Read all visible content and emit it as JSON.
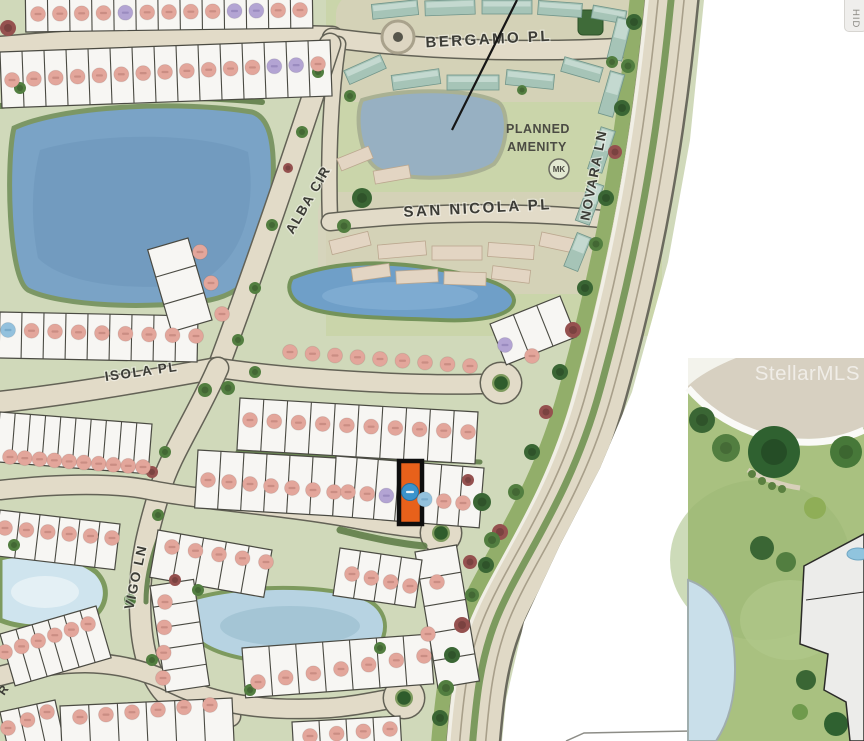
{
  "watermark": "StellarMLS",
  "hide_button": {
    "label": "HID"
  },
  "streets": {
    "bergamo": "BERGAMO PL",
    "san_nicola": "SAN NICOLA PL",
    "novara": "NOVARA LN",
    "alba": "ALBA CIR",
    "isola": "ISOLA PL",
    "vigo": "VIGO LN",
    "partial_r": "R"
  },
  "amenity": {
    "line1": "PLANNED",
    "line2": "AMENITY",
    "badge": "MK"
  },
  "colors": {
    "marker_pink": "#E3A69B",
    "marker_purple": "#B3A4D3",
    "marker_blue": "#93C1DD",
    "marker_pink_text": "#C2847B",
    "marker_purple_text": "#9183B8",
    "marker_blue_text": "#6FA3C4",
    "highlight_orange": "#E8611B",
    "highlight_outline": "#0E0E0E",
    "highlight_marker_blue": "#3B93CC",
    "lot_fill": "#F7F6F3",
    "lot_stroke": "#4A4A42",
    "road_tan": "#E2DBC8",
    "road_edge": "#636256",
    "base_green": "#D0D9BA",
    "water_dark": "#7AA3C6",
    "water_light": "#B7D3E2"
  },
  "highlighted_lot": {
    "x": 399,
    "y": 461,
    "w": 23,
    "h": 63,
    "marker_x": 410,
    "marker_y": 492
  },
  "map": {
    "lakes": [
      {
        "d": "M14,128 C60,106 180,100 252,112 C272,118 276,150 272,200 C268,252 258,290 210,300 C150,310 60,306 28,290 C8,278 6,160 14,128 Z",
        "f": "#7AA3C6",
        "s": "#7C9765",
        "sw": 5
      },
      {
        "d": "M40,150 C100,132 200,132 248,152 C256,200 248,258 198,283 C130,293 62,283 38,258 C30,218 32,180 40,150 Z",
        "f": "#6B95BA",
        "o": 0.55
      },
      {
        "d": "M362,100 C400,88 470,88 498,102 C510,110 508,148 494,164 C470,180 410,182 380,170 C360,162 354,116 362,100 Z",
        "f": "#97B0C2",
        "s": "#A9B193",
        "sw": 4
      },
      {
        "d": "M292,278 C330,262 380,260 430,268 C480,276 512,284 514,300 C514,314 488,322 440,320 C392,318 330,318 304,306 C290,300 286,288 292,278 Z",
        "f": "#6F9FC8",
        "s": "#74935A",
        "sw": 4
      },
      {
        "e": [
          400,
          296,
          78,
          14
        ],
        "f": "#8AB4D8",
        "o": 0.55
      },
      {
        "d": "M196,598 C240,586 310,584 356,596 C382,602 390,622 382,640 C370,660 320,668 268,662 C228,658 200,648 192,632 C186,618 188,606 196,598 Z",
        "f": "#B7D3E2",
        "s": "#7D9A5E",
        "sw": 4
      },
      {
        "e": [
          290,
          626,
          70,
          20
        ],
        "f": "#98BCCD",
        "o": 0.6
      },
      {
        "d": "M0,558 C36,550 76,556 96,572 C110,586 108,606 92,618 C68,630 24,630 0,620 Z",
        "f": "#CFE4EE",
        "s": "#7D9A5E",
        "sw": 5
      },
      {
        "e": [
          45,
          592,
          34,
          16
        ],
        "f": "#E8F2F6",
        "o": 0.8
      }
    ],
    "roads": [
      {
        "d": "M0,48 C110,38 220,34 332,38",
        "w": 22
      },
      {
        "d": "M332,38 C420,50 540,54 648,46",
        "w": 18
      },
      {
        "d": "M338,44 C330,100 328,160 330,222",
        "w": 14
      },
      {
        "d": "M330,222 C420,212 520,210 612,220",
        "w": 16
      },
      {
        "d": "M330,44 C302,130 262,250 218,368",
        "w": 20
      },
      {
        "d": "M0,402 C80,393 150,380 218,368",
        "w": 20
      },
      {
        "d": "M218,368 C300,380 420,386 482,384",
        "w": 18,
        "b": [
          501,
          383,
          20
        ]
      },
      {
        "d": "M218,368 C195,420 170,455 160,490 C148,530 140,560 140,600 C140,645 148,672 162,690 C175,706 198,714 230,716",
        "w": 20
      },
      {
        "d": "M0,490 C55,484 110,482 150,490 C200,500 280,505 352,518 C385,524 405,527 420,528",
        "w": 18,
        "b": [
          441,
          533,
          20
        ]
      },
      {
        "d": "M0,676 C70,657 122,658 176,685 C214,703 260,712 330,708 C355,706 372,702 384,700",
        "w": 18,
        "b": [
          404,
          698,
          20
        ]
      }
    ],
    "novara_layers": [
      {
        "d": "M672,-10 C658,140 636,260 600,390 C570,500 520,560 496,620 C480,660 476,700 472,750",
        "w": 57,
        "c": "#6B6A5E"
      },
      {
        "d": "M672,-10 C658,140 636,260 600,390 C570,500 520,560 496,620 C480,660 476,700 472,750",
        "w": 52,
        "c": "#E0D9C6"
      },
      {
        "d": "M659,-10 C645,140 623,260 587,390 C557,500 507,560 483,620 C467,660 463,700 459,750",
        "w": 1.6,
        "c": "#A89F8A"
      },
      {
        "d": "M685,-10 C671,140 649,260 613,390 C583,500 533,560 509,620 C493,660 489,700 485,750",
        "w": 1.6,
        "c": "#A89F8A"
      },
      {
        "d": "M672,-10 C658,140 636,260 600,390 C570,500 520,560 496,620 C480,660 476,700 472,750",
        "w": 7,
        "c": "#7C9A5E"
      },
      {
        "d": "M648,-10 C634,140 612,260 576,390 C546,500 496,560 472,620 C456,660 452,700 448,750",
        "w": 3.5,
        "c": "#F1EFE6"
      },
      {
        "d": "M638,-10 C624,140 602,260 566,390 C536,500 486,560 462,620 C446,660 442,700 438,750",
        "w": 15,
        "c": "#92AE6A"
      }
    ],
    "hedges": [
      {
        "d": "M238,452 L480,462",
        "w": 5
      },
      {
        "d": "M340,530 C370,538 402,544 424,546",
        "w": 7
      },
      {
        "d": "M0,106 C80,98 180,94 262,102",
        "w": 6
      },
      {
        "d": "M158,540 C150,562 146,582 146,602",
        "w": 5
      }
    ],
    "bands": [
      [
        25,
        -28,
        312,
        -32,
        60,
        13
      ],
      [
        0,
        52,
        330,
        40,
        56,
        15
      ],
      [
        0,
        312,
        198,
        316,
        46,
        9
      ],
      [
        188,
        238,
        212,
        320,
        42,
        3
      ],
      [
        0,
        412,
        152,
        424,
        50,
        10
      ],
      [
        240,
        398,
        478,
        412,
        52,
        10
      ],
      [
        336,
        456,
        484,
        468,
        60,
        7
      ],
      [
        198,
        450,
        336,
        458,
        58,
        6
      ],
      [
        0,
        510,
        120,
        524,
        46,
        6
      ],
      [
        158,
        530,
        272,
        550,
        48,
        5
      ],
      [
        150,
        586,
        166,
        692,
        -44,
        5
      ],
      [
        0,
        634,
        96,
        606,
        54,
        6
      ],
      [
        0,
        712,
        55,
        700,
        42,
        3
      ],
      [
        60,
        706,
        232,
        698,
        44,
        6
      ],
      [
        242,
        648,
        430,
        634,
        50,
        7
      ],
      [
        292,
        722,
        400,
        716,
        32,
        4
      ],
      [
        415,
        552,
        438,
        688,
        -42,
        5
      ],
      [
        340,
        548,
        422,
        560,
        48,
        4
      ],
      [
        490,
        324,
        560,
        296,
        44,
        3
      ]
    ],
    "marker_rows": [
      {
        "p": [
          38,
          14,
          300,
          10
        ],
        "c": "ppppPppppPPpp"
      },
      {
        "p": [
          12,
          80,
          318,
          64
        ],
        "c": "ppppppppppppPPp"
      },
      {
        "p": [
          200,
          252,
          222,
          314
        ],
        "c": "ppp"
      },
      {
        "p": [
          8,
          330,
          196,
          336
        ],
        "c": "bpppppppp"
      },
      {
        "p": [
          290,
          352,
          470,
          366
        ],
        "c": "ppppppppp"
      },
      {
        "p": [
          505,
          345,
          532,
          356
        ],
        "c": "Pp"
      },
      {
        "p": [
          10,
          457,
          143,
          467
        ],
        "c": "pppppppppp"
      },
      {
        "p": [
          250,
          420,
          468,
          432
        ],
        "c": "pppppppppp"
      },
      {
        "p": [
          208,
          480,
          334,
          492
        ],
        "c": "ppppppp"
      },
      {
        "p": [
          348,
          492,
          463,
          503
        ],
        "c": "ppP.bpp"
      },
      {
        "p": [
          5,
          528,
          112,
          538
        ],
        "c": "pppppp"
      },
      {
        "p": [
          172,
          547,
          266,
          562
        ],
        "c": "ppppp"
      },
      {
        "p": [
          165,
          602,
          163,
          678
        ],
        "c": "pppp"
      },
      {
        "p": [
          5,
          652,
          88,
          624
        ],
        "c": "pppppp"
      },
      {
        "p": [
          8,
          728,
          47,
          712
        ],
        "c": "ppp"
      },
      {
        "p": [
          80,
          717,
          210,
          705
        ],
        "c": "pppppp"
      },
      {
        "p": [
          258,
          682,
          424,
          656
        ],
        "c": "ppppppp"
      },
      {
        "p": [
          310,
          736,
          390,
          729
        ],
        "c": "pppp"
      },
      {
        "p": [
          437,
          582,
          428,
          634
        ],
        "c": "pp"
      },
      {
        "p": [
          352,
          574,
          410,
          586
        ],
        "c": "pppp"
      }
    ],
    "buildings": [
      [
        372,
        2,
        46,
        15,
        -6,
        "t"
      ],
      [
        425,
        0,
        50,
        15,
        -2,
        "t"
      ],
      [
        482,
        0,
        50,
        14,
        0,
        "t"
      ],
      [
        538,
        2,
        44,
        14,
        4,
        "t"
      ],
      [
        592,
        8,
        34,
        13,
        10,
        "t"
      ],
      [
        345,
        62,
        40,
        15,
        -24,
        "t"
      ],
      [
        392,
        72,
        48,
        15,
        -8,
        "t"
      ],
      [
        447,
        75,
        52,
        15,
        0,
        "t"
      ],
      [
        506,
        72,
        48,
        15,
        6,
        "t"
      ],
      [
        562,
        62,
        40,
        15,
        16,
        "t"
      ],
      [
        338,
        152,
        34,
        13,
        -22,
        "b"
      ],
      [
        374,
        168,
        36,
        13,
        -10,
        "b"
      ],
      [
        330,
        236,
        40,
        14,
        -14,
        "b"
      ],
      [
        378,
        243,
        48,
        14,
        -5,
        "b"
      ],
      [
        432,
        246,
        50,
        14,
        0,
        "b"
      ],
      [
        488,
        244,
        46,
        14,
        4,
        "b"
      ],
      [
        540,
        236,
        40,
        14,
        12,
        "b"
      ],
      [
        352,
        266,
        38,
        13,
        -8,
        "b"
      ],
      [
        396,
        270,
        42,
        13,
        -3,
        "b"
      ],
      [
        444,
        272,
        42,
        13,
        2,
        "b"
      ],
      [
        492,
        268,
        38,
        13,
        7,
        "b"
      ],
      [
        612,
        18,
        15,
        42,
        14,
        "t"
      ],
      [
        604,
        72,
        15,
        44,
        16,
        "t"
      ],
      [
        594,
        128,
        15,
        44,
        18,
        "t"
      ],
      [
        582,
        182,
        15,
        42,
        20,
        "t"
      ],
      [
        570,
        234,
        15,
        36,
        22,
        "t"
      ]
    ],
    "trees": [
      [
        8,
        28,
        8,
        "m"
      ],
      [
        20,
        88,
        6,
        "G"
      ],
      [
        318,
        72,
        6,
        "G"
      ],
      [
        302,
        132,
        6,
        "G"
      ],
      [
        288,
        168,
        5,
        "m"
      ],
      [
        272,
        225,
        6,
        "G"
      ],
      [
        255,
        288,
        6,
        "G"
      ],
      [
        238,
        340,
        6,
        "G"
      ],
      [
        228,
        388,
        7,
        "G"
      ],
      [
        350,
        96,
        6,
        "G"
      ],
      [
        362,
        198,
        10,
        "g"
      ],
      [
        344,
        226,
        7,
        "G"
      ],
      [
        522,
        90,
        5,
        "G"
      ],
      [
        612,
        62,
        6,
        "G"
      ],
      [
        634,
        22,
        8,
        "g"
      ],
      [
        628,
        66,
        7,
        "G"
      ],
      [
        622,
        108,
        8,
        "g"
      ],
      [
        615,
        152,
        7,
        "m"
      ],
      [
        606,
        198,
        8,
        "g"
      ],
      [
        596,
        244,
        7,
        "G"
      ],
      [
        585,
        288,
        8,
        "g"
      ],
      [
        573,
        330,
        8,
        "m"
      ],
      [
        560,
        372,
        8,
        "g"
      ],
      [
        546,
        412,
        7,
        "m"
      ],
      [
        532,
        452,
        8,
        "g"
      ],
      [
        516,
        492,
        8,
        "G"
      ],
      [
        500,
        532,
        8,
        "m"
      ],
      [
        486,
        565,
        8,
        "g"
      ],
      [
        472,
        595,
        7,
        "G"
      ],
      [
        462,
        625,
        8,
        "m"
      ],
      [
        452,
        655,
        8,
        "g"
      ],
      [
        446,
        688,
        8,
        "G"
      ],
      [
        440,
        718,
        8,
        "g"
      ],
      [
        482,
        502,
        9,
        "g"
      ],
      [
        492,
        540,
        8,
        "G"
      ],
      [
        470,
        562,
        7,
        "m"
      ],
      [
        468,
        480,
        6,
        "m"
      ],
      [
        152,
        472,
        6,
        "m"
      ],
      [
        165,
        452,
        6,
        "G"
      ],
      [
        158,
        515,
        6,
        "G"
      ],
      [
        130,
        600,
        6,
        "G"
      ],
      [
        152,
        660,
        6,
        "G"
      ],
      [
        205,
        390,
        7,
        "G"
      ],
      [
        198,
        590,
        6,
        "G"
      ],
      [
        380,
        648,
        6,
        "G"
      ],
      [
        14,
        545,
        6,
        "G"
      ],
      [
        250,
        690,
        6,
        "G"
      ],
      [
        175,
        580,
        6,
        "m"
      ],
      [
        255,
        372,
        6,
        "G"
      ]
    ]
  }
}
